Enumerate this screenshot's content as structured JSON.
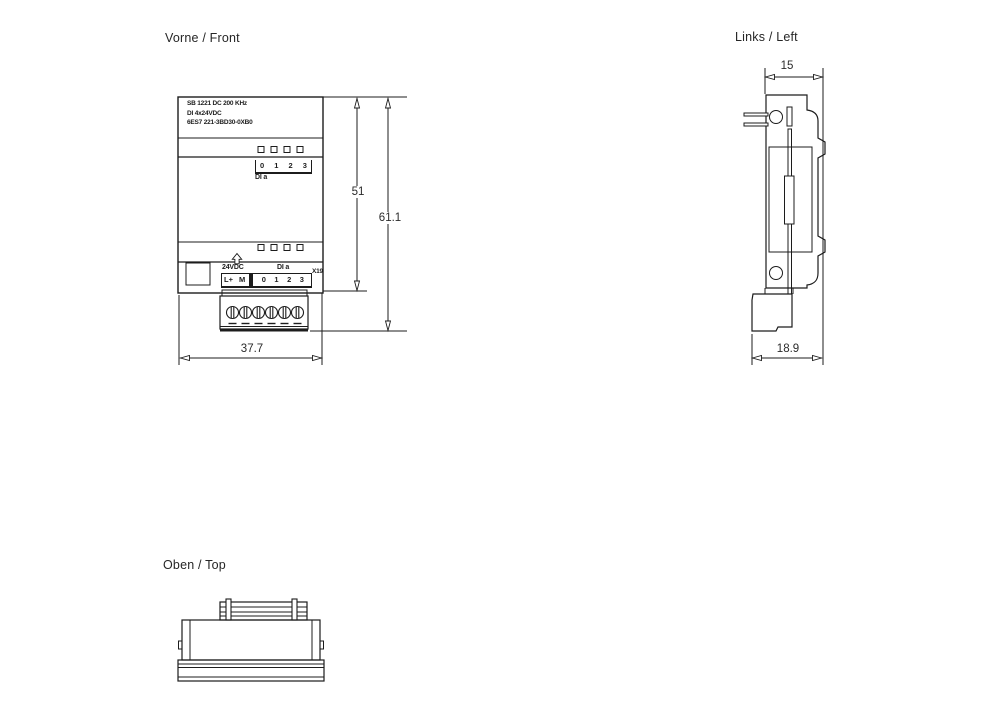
{
  "titles": {
    "front": "Vorne / Front",
    "left": "Links / Left",
    "top": "Oben / Top"
  },
  "front_view": {
    "module_label": {
      "line1": "SB 1221 DC 200 KHz",
      "line2": "DI 4x24VDC",
      "line3": "6ES7 221-3BD30-0XB0"
    },
    "channels": [
      "0",
      "1",
      "2",
      "3"
    ],
    "group_label": "DI a",
    "power_label": "24VDC",
    "group_label_terminals": "DI a",
    "terminals": [
      "L+",
      "M",
      "0",
      "1",
      "2",
      "3"
    ],
    "connector_label": "X19",
    "dim_height_body": "51",
    "dim_height_total": "61.1",
    "dim_width": "37.7"
  },
  "left_view": {
    "dim_depth_body": "15",
    "dim_depth_total": "18.9"
  },
  "colors": {
    "line": "#1c1c1c",
    "text": "#262626",
    "background": "#ffffff"
  }
}
